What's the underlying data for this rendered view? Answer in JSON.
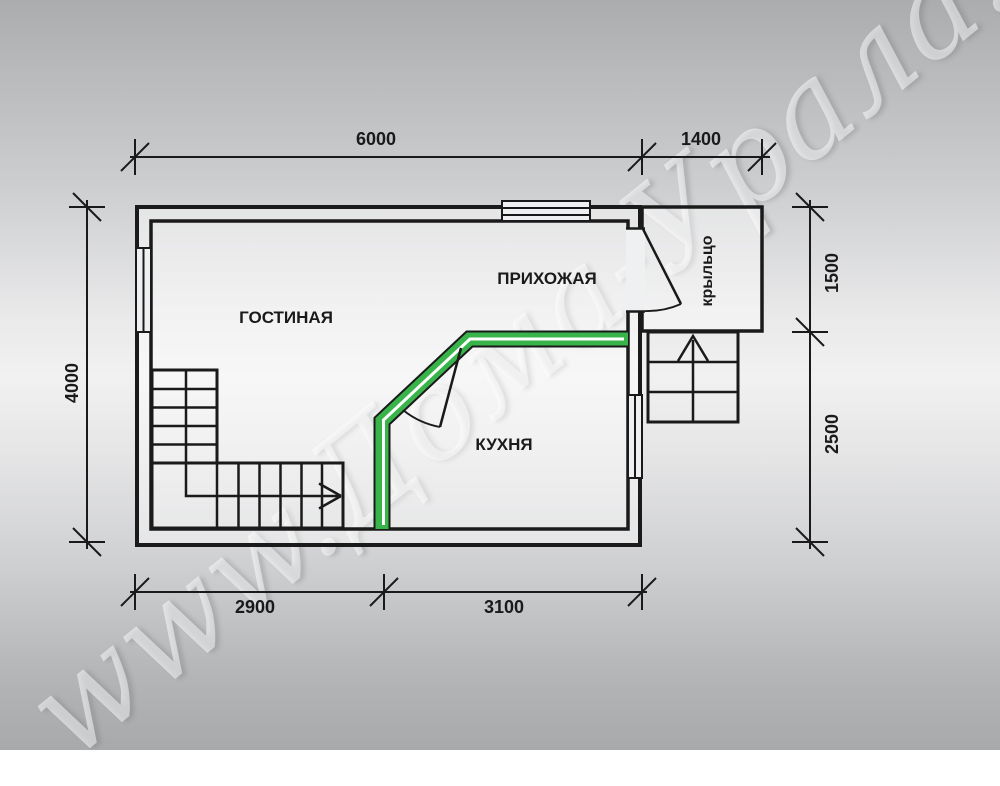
{
  "title": "План этажа (floor plan)",
  "watermark": {
    "text": "www.Дома-Урала.рф"
  },
  "colors": {
    "line": "#1a1a1a",
    "partition_green": "#38b44a",
    "partition_center_line": "#ffffff",
    "background_mid": "#f1f1f2"
  },
  "rooms": [
    {
      "label": "ГОСТИНАЯ"
    },
    {
      "label": "ПРИХОЖАЯ"
    },
    {
      "label": "КУХНЯ"
    },
    {
      "label": "крыльцо"
    }
  ],
  "dimensions": {
    "top": [
      {
        "label": "6000"
      },
      {
        "label": "1400"
      }
    ],
    "bottom": [
      {
        "label": "2900"
      },
      {
        "label": "3100"
      }
    ],
    "left": [
      {
        "label": "4000"
      }
    ],
    "right": [
      {
        "label": "1500"
      },
      {
        "label": "2500"
      }
    ]
  }
}
